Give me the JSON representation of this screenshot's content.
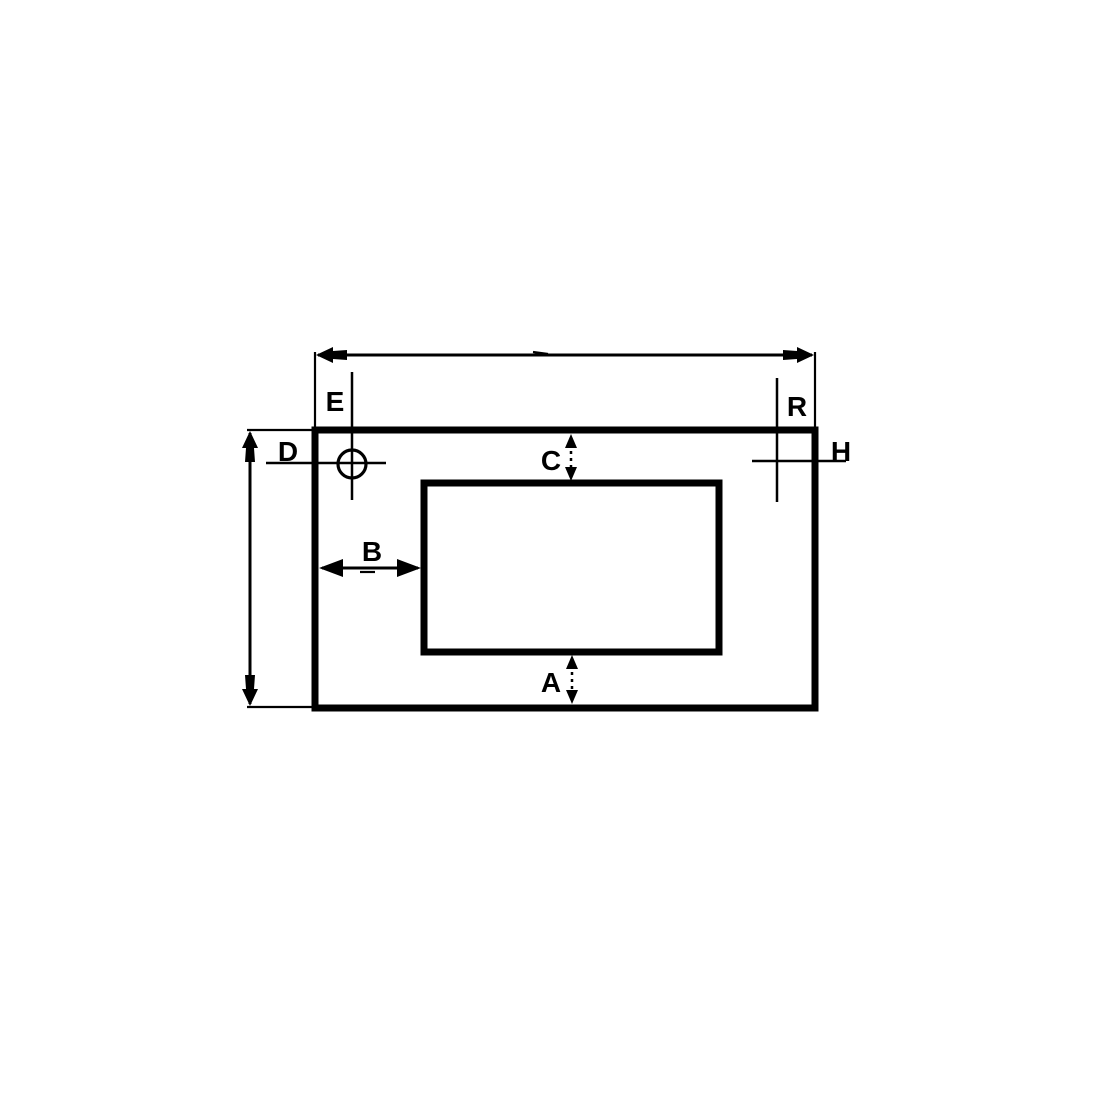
{
  "drawing": {
    "background_color": "#ffffff",
    "line_color": "#000000",
    "labels": {
      "A": "A",
      "B": "B",
      "C": "C",
      "D": "D",
      "E": "E",
      "R": "R",
      "H": "H"
    }
  }
}
